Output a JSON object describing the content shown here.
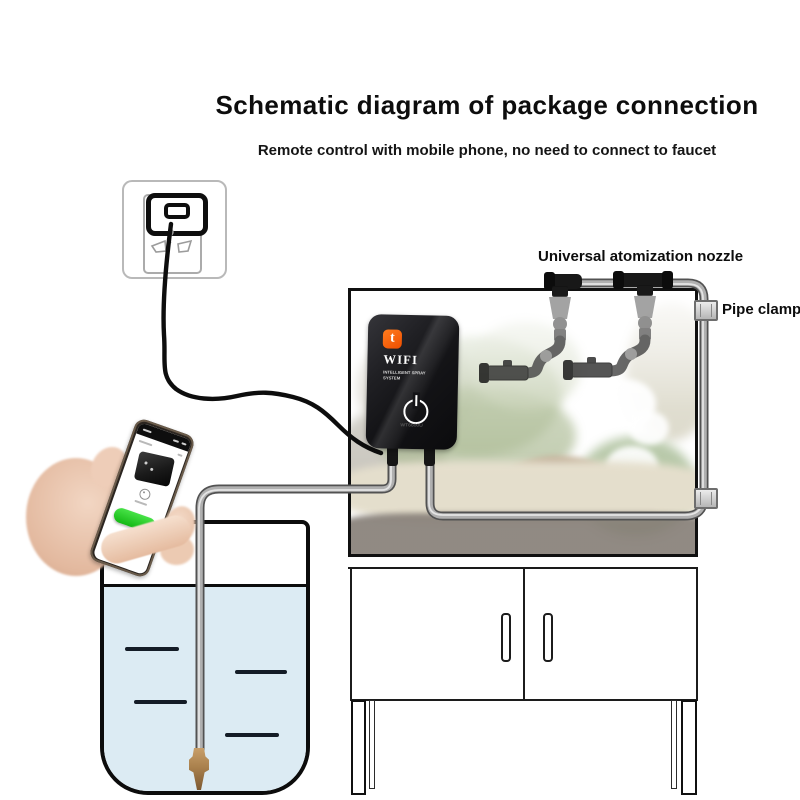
{
  "header": {
    "title": "Schematic diagram of package connection",
    "subtitle": "Remote control with mobile phone, no need to connect to faucet"
  },
  "annotations": {
    "nozzle_label": "Universal atomization nozzle",
    "pipe_clamp_label": "Pipe clamp"
  },
  "device": {
    "logo_glyph": "t",
    "name": "WIFI",
    "tagline_line1": "INTELLIGENT SPRAY",
    "tagline_line2": "SYSTEM",
    "model": "WT6600U"
  },
  "colors": {
    "accent_orange": "#f25c05",
    "app_button_green": "#2fd32f",
    "water_blue": "#dcebf3",
    "tube_gray": "#b0b0b0",
    "text_black": "#0d0d0d"
  }
}
